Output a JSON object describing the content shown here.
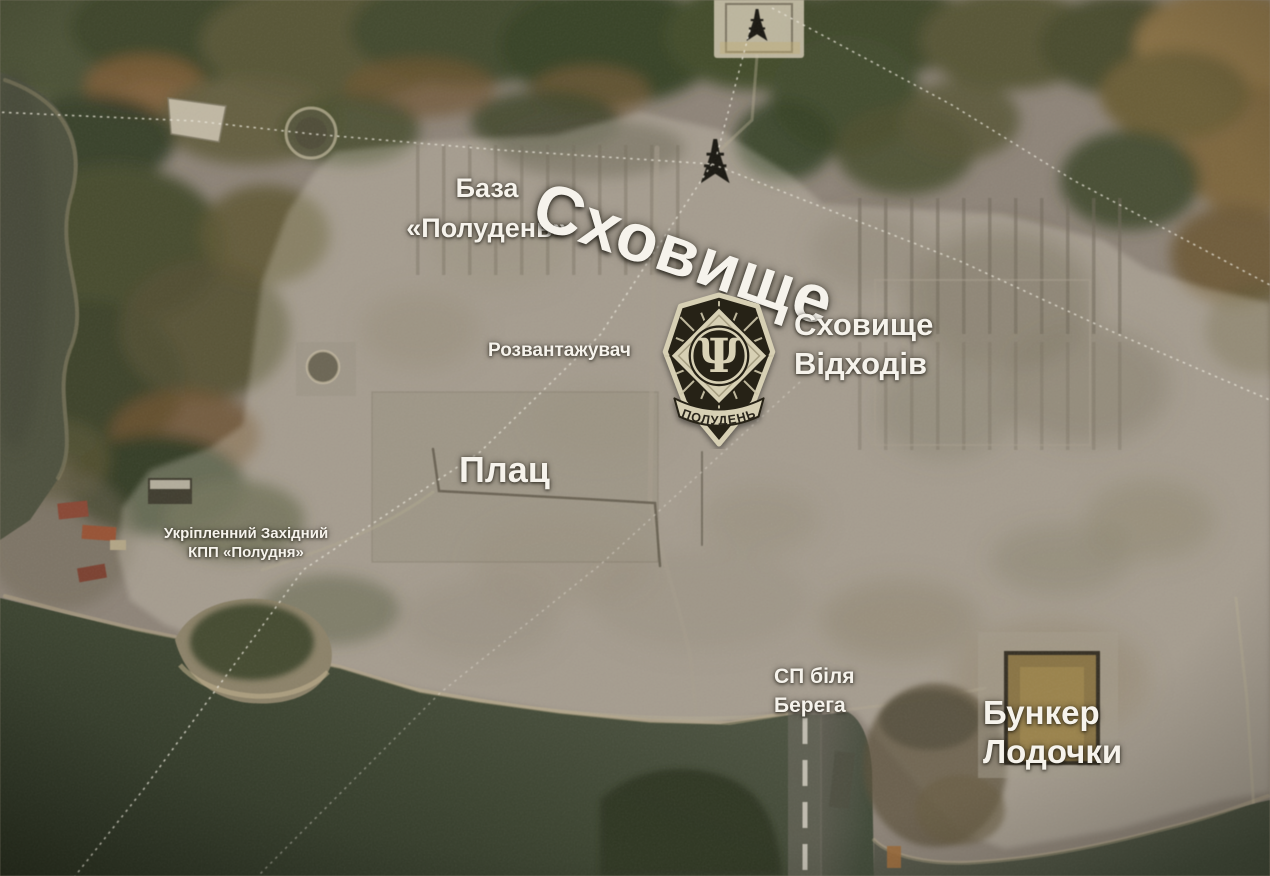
{
  "map": {
    "region_title": "Сховище",
    "labels": {
      "base": {
        "line1": "База",
        "line2": "«Полудень»"
      },
      "unloader": "Розвантажувач",
      "waste_storage": {
        "line1": "Сховище",
        "line2": "Відходів"
      },
      "parade_ground": "Плац",
      "west_checkpoint": {
        "line1": "Укріпленний Західний",
        "line2": "КПП «Полудня»"
      },
      "shore_post": {
        "line1": "СП біля",
        "line2": "Берега"
      },
      "boat_bunker": {
        "line1": "Бункер",
        "line2": "Лодочки"
      }
    },
    "emblem": {
      "symbol": "Ψ",
      "banner": "ПОЛУДЕНЬ"
    },
    "colors": {
      "label_text": "#f6f3ec",
      "emblem_cream": "#d7d0b4",
      "emblem_dark": "#282318",
      "highlight_overlay": "#ddd6c4",
      "terrain_base": "#8d8376",
      "water_dark": "#2b321f",
      "water_grey": "#5e5b50",
      "forest_green": "#3a4326",
      "autumn_brown": "#7c5c32"
    }
  }
}
